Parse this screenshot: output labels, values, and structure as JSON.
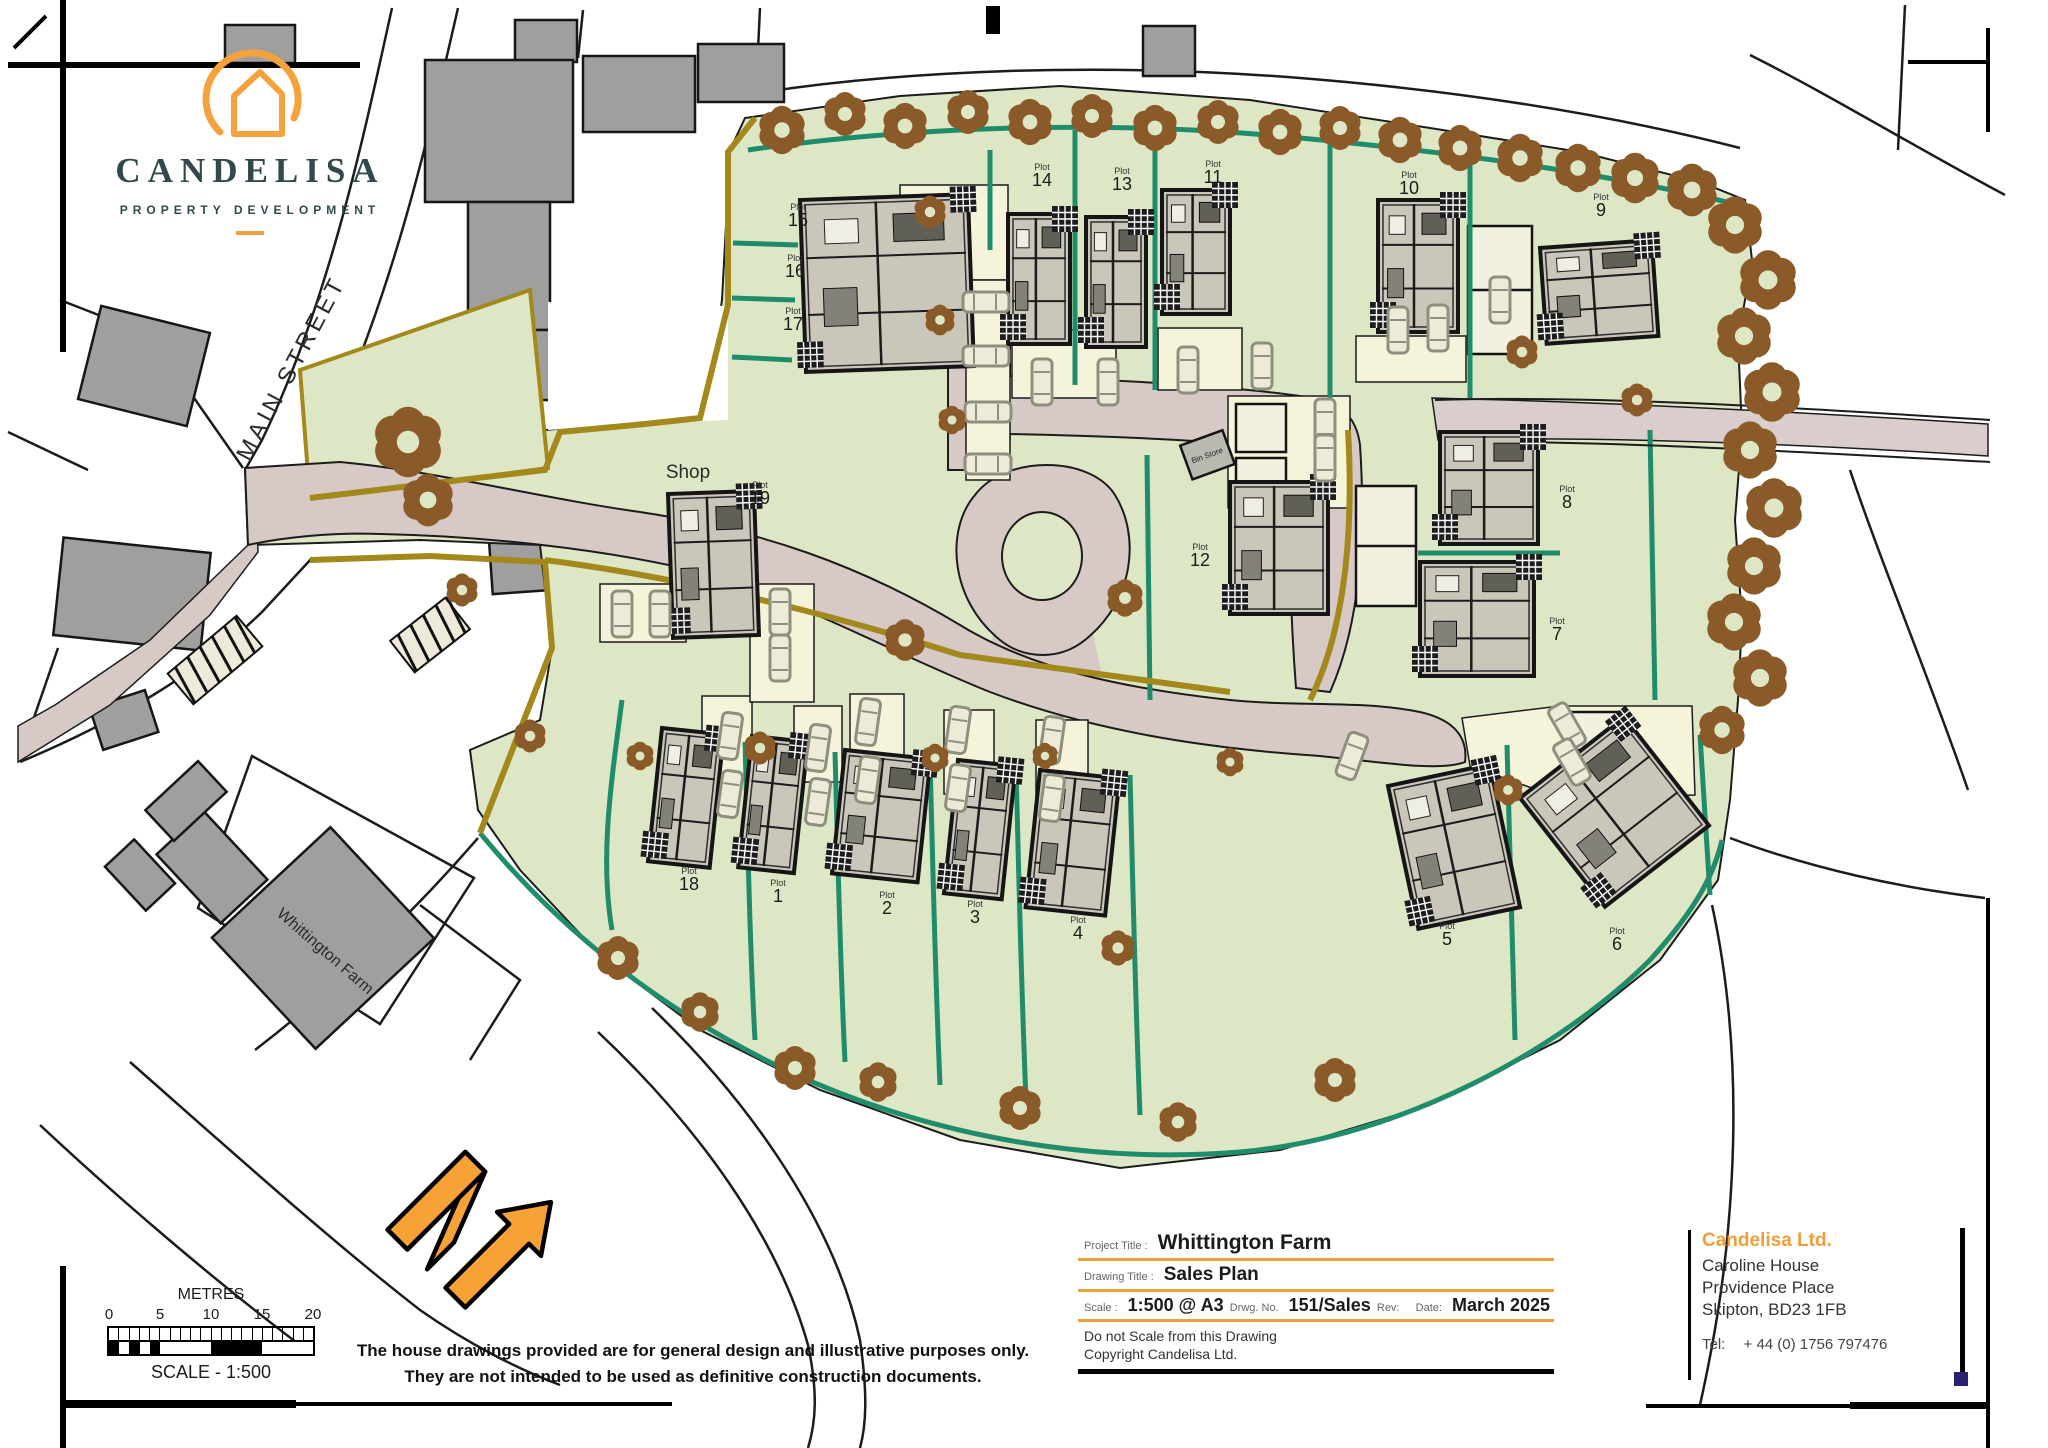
{
  "logo": {
    "name": "CANDELISA",
    "tagline": "PROPERTY DEVELOPMENT"
  },
  "map": {
    "street_label": "MAIN STREET",
    "shop_label": "Shop",
    "farm_label": "Whittington Farm",
    "bin_store_label": "Bin Store",
    "plot_prefix": "Plot",
    "plots": [
      {
        "num": "15",
        "lx": 798,
        "ly": 226,
        "house": {
          "x": 800,
          "y": 200,
          "w": 168,
          "h": 172,
          "rot": -2
        }
      },
      {
        "num": "16",
        "lx": 795,
        "ly": 277,
        "house": null
      },
      {
        "num": "17",
        "lx": 793,
        "ly": 330,
        "house": null
      },
      {
        "num": "14",
        "lx": 1042,
        "ly": 186,
        "house": {
          "x": 1008,
          "y": 214,
          "w": 62,
          "h": 130,
          "rot": 0
        }
      },
      {
        "num": "13",
        "lx": 1122,
        "ly": 190,
        "house": {
          "x": 1086,
          "y": 217,
          "w": 60,
          "h": 130,
          "rot": 0
        }
      },
      {
        "num": "11",
        "lx": 1213,
        "ly": 183,
        "house": {
          "x": 1162,
          "y": 190,
          "w": 68,
          "h": 124,
          "rot": 0
        }
      },
      {
        "num": "10",
        "lx": 1409,
        "ly": 194,
        "house": {
          "x": 1378,
          "y": 200,
          "w": 80,
          "h": 132,
          "rot": 0
        }
      },
      {
        "num": "9",
        "lx": 1601,
        "ly": 216,
        "house": {
          "x": 1540,
          "y": 248,
          "w": 112,
          "h": 96,
          "rot": -4
        }
      },
      {
        "num": "12",
        "lx": 1200,
        "ly": 566,
        "house": {
          "x": 1230,
          "y": 482,
          "w": 98,
          "h": 132,
          "rot": 0
        }
      },
      {
        "num": "8",
        "lx": 1567,
        "ly": 508,
        "house": {
          "x": 1440,
          "y": 432,
          "w": 98,
          "h": 112,
          "rot": 0
        }
      },
      {
        "num": "7",
        "lx": 1557,
        "ly": 640,
        "house": {
          "x": 1420,
          "y": 562,
          "w": 114,
          "h": 114,
          "rot": 0
        }
      },
      {
        "num": "19",
        "lx": 760,
        "ly": 504,
        "house": {
          "x": 668,
          "y": 494,
          "w": 86,
          "h": 144,
          "rot": -2
        }
      },
      {
        "num": "18",
        "lx": 689,
        "ly": 890,
        "house": {
          "x": 662,
          "y": 728,
          "w": 62,
          "h": 134,
          "rot": 6
        }
      },
      {
        "num": "1",
        "lx": 778,
        "ly": 902,
        "house": {
          "x": 752,
          "y": 736,
          "w": 56,
          "h": 132,
          "rot": 6
        }
      },
      {
        "num": "2",
        "lx": 887,
        "ly": 914,
        "house": {
          "x": 845,
          "y": 750,
          "w": 86,
          "h": 124,
          "rot": 6
        }
      },
      {
        "num": "3",
        "lx": 975,
        "ly": 923,
        "house": {
          "x": 958,
          "y": 760,
          "w": 58,
          "h": 134,
          "rot": 6
        }
      },
      {
        "num": "4",
        "lx": 1078,
        "ly": 939,
        "house": {
          "x": 1040,
          "y": 770,
          "w": 80,
          "h": 138,
          "rot": 6
        }
      },
      {
        "num": "5",
        "lx": 1447,
        "ly": 945,
        "house": {
          "x": 1388,
          "y": 786,
          "w": 104,
          "h": 146,
          "rot": -12
        }
      },
      {
        "num": "6",
        "lx": 1617,
        "ly": 950,
        "house": {
          "x": 1520,
          "y": 798,
          "w": 132,
          "h": 138,
          "rot": -38
        }
      }
    ],
    "trees": [
      [
        782,
        130,
        22
      ],
      [
        845,
        114,
        20
      ],
      [
        905,
        126,
        21
      ],
      [
        968,
        112,
        20
      ],
      [
        1030,
        122,
        21
      ],
      [
        1092,
        116,
        20
      ],
      [
        1155,
        128,
        21
      ],
      [
        1218,
        122,
        20
      ],
      [
        1280,
        132,
        21
      ],
      [
        1340,
        128,
        20
      ],
      [
        1400,
        140,
        21
      ],
      [
        1460,
        148,
        21
      ],
      [
        1520,
        158,
        22
      ],
      [
        1578,
        168,
        22
      ],
      [
        1635,
        178,
        23
      ],
      [
        1692,
        190,
        24
      ],
      [
        1735,
        225,
        26
      ],
      [
        1768,
        280,
        27
      ],
      [
        1744,
        336,
        26
      ],
      [
        1772,
        392,
        27
      ],
      [
        1750,
        450,
        26
      ],
      [
        1774,
        508,
        27
      ],
      [
        1754,
        566,
        26
      ],
      [
        1734,
        622,
        26
      ],
      [
        1760,
        678,
        26
      ],
      [
        1722,
        730,
        22
      ],
      [
        408,
        442,
        32
      ],
      [
        428,
        500,
        24
      ],
      [
        462,
        590,
        15
      ],
      [
        930,
        212,
        15
      ],
      [
        940,
        320,
        14
      ],
      [
        952,
        420,
        13
      ],
      [
        905,
        640,
        19
      ],
      [
        760,
        748,
        15
      ],
      [
        640,
        756,
        13
      ],
      [
        530,
        736,
        15
      ],
      [
        618,
        958,
        20
      ],
      [
        700,
        1012,
        18
      ],
      [
        795,
        1068,
        20
      ],
      [
        878,
        1082,
        18
      ],
      [
        1020,
        1108,
        20
      ],
      [
        1178,
        1122,
        18
      ],
      [
        1335,
        1080,
        20
      ],
      [
        1118,
        948,
        16
      ],
      [
        1230,
        762,
        13
      ],
      [
        935,
        758,
        13
      ],
      [
        1045,
        756,
        12
      ],
      [
        1125,
        598,
        17
      ],
      [
        1522,
        352,
        15
      ],
      [
        1637,
        400,
        15
      ],
      [
        1508,
        790,
        14
      ]
    ],
    "cars": [
      [
        986,
        302,
        90
      ],
      [
        986,
        356,
        90
      ],
      [
        988,
        412,
        90
      ],
      [
        988,
        464,
        90
      ],
      [
        1042,
        382,
        0
      ],
      [
        1108,
        382,
        0
      ],
      [
        1188,
        370,
        0
      ],
      [
        1262,
        366,
        0
      ],
      [
        1398,
        330,
        0
      ],
      [
        1438,
        328,
        0
      ],
      [
        1500,
        300,
        0
      ],
      [
        1325,
        422,
        0
      ],
      [
        1325,
        458,
        0
      ],
      [
        730,
        736,
        8
      ],
      [
        730,
        794,
        8
      ],
      [
        818,
        748,
        8
      ],
      [
        818,
        802,
        8
      ],
      [
        868,
        722,
        8
      ],
      [
        868,
        780,
        8
      ],
      [
        958,
        730,
        8
      ],
      [
        958,
        788,
        8
      ],
      [
        1052,
        740,
        8
      ],
      [
        1052,
        798,
        8
      ],
      [
        1352,
        756,
        20
      ],
      [
        1567,
        726,
        -30
      ],
      [
        1572,
        762,
        -30
      ],
      [
        622,
        614,
        0
      ],
      [
        660,
        614,
        0
      ],
      [
        780,
        612,
        0
      ],
      [
        780,
        658,
        0
      ]
    ]
  },
  "scale_bar": {
    "unit_label": "METRES",
    "ticks": [
      "0",
      "5",
      "10",
      "15",
      "20"
    ],
    "caption": "SCALE - 1:500"
  },
  "disclaimer": {
    "line1": "The house drawings provided are for general design and illustrative purposes only.",
    "line2": "They are not intended to be used as definitive construction documents."
  },
  "title_block": {
    "project_label": "Project Title :",
    "project": "Whittington Farm",
    "drawing_label": "Drawing Title :",
    "drawing": "Sales Plan",
    "scale_label": "Scale :",
    "scale": "1:500 @ A3",
    "drwg_label": "Drwg. No.",
    "drwg": "151/Sales",
    "rev_label": "Rev:",
    "rev": "",
    "date_label": "Date:",
    "date": "March 2025",
    "note1": "Do not Scale from this Drawing",
    "note2": "Copyright Candelisa Ltd."
  },
  "company": {
    "name": "Candelisa Ltd.",
    "addr1": "Caroline House",
    "addr2": "Providence Place",
    "addr3": "Skipton, BD23 1FB",
    "tel_label": "Tel:",
    "tel": "+ 44 (0) 1756 797476"
  },
  "colors": {
    "accent_orange": "#F29D3D",
    "logo_dark": "#31494A",
    "site_green": "#DDE7C6",
    "boundary_teal": "#1F8D6B",
    "boundary_olive": "#A3891B",
    "road_mauve": "#D6C9C6",
    "tree_brown": "#8A5A28",
    "house_fill": "#CAC6BA",
    "cream": "#F6F3DB",
    "navy": "#2B2171"
  }
}
